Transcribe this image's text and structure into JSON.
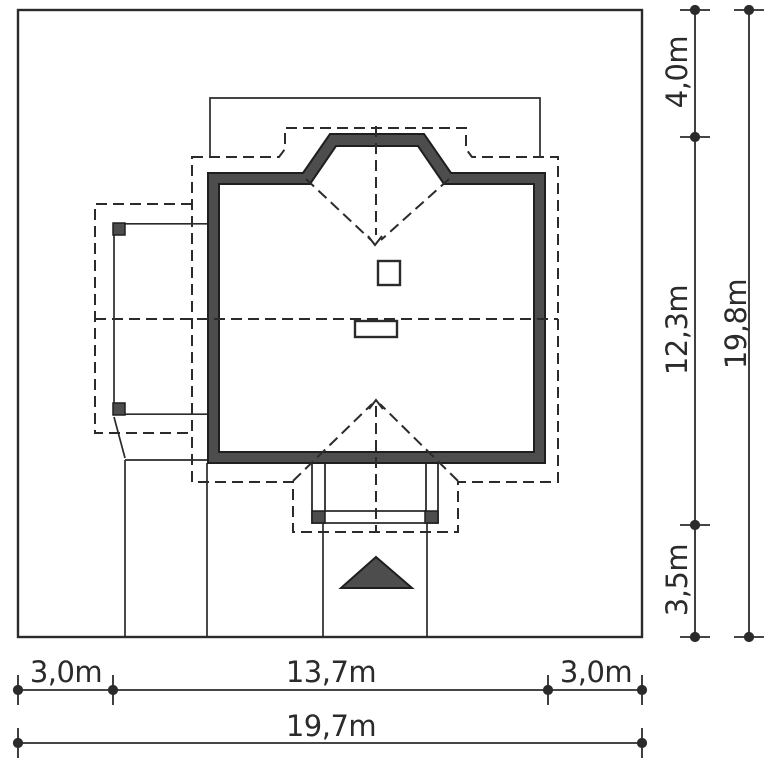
{
  "diagram": {
    "type": "architectural-site-plan",
    "units": "m",
    "description": "Top view site plan of a single family house plot with setback and plot dimensions"
  },
  "colors": {
    "background": "#ffffff",
    "line": "#2b2b2b",
    "wall_fill": "#4d4d4d"
  },
  "dimensions": {
    "bottom": {
      "segment_1": "3,0m",
      "segment_2": "13,7m",
      "segment_3": "3,0m",
      "total": "19,7m"
    },
    "right": {
      "segment_1": "4,0m",
      "segment_2": "12,3m",
      "segment_3": "3,5m",
      "total": "19,8m"
    }
  },
  "measurements": {
    "plot_width_m": 19.7,
    "plot_depth_m": 19.8,
    "left_setback_m": 3.0,
    "house_with_carport_width_m": 13.7,
    "right_setback_m": 3.0,
    "front_offset_m": 4.0,
    "house_depth_m": 12.3,
    "rear_setback_m": 3.5
  }
}
